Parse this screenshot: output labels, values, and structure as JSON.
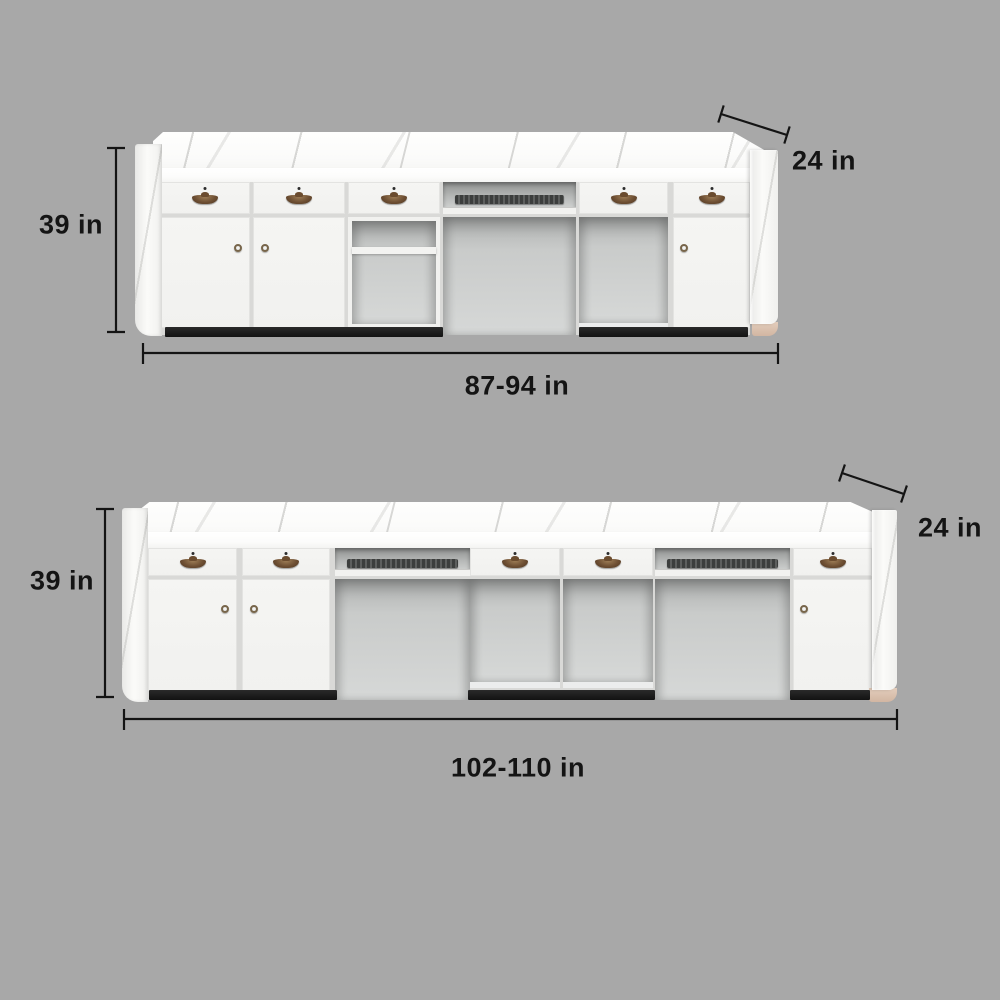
{
  "page": {
    "background_color": "#a8a8a8",
    "type": "furniture dimension diagram"
  },
  "figures": [
    {
      "name": "reception-desk-small",
      "height_label": "39 in",
      "depth_label": "24 in",
      "width_label": "87-94 in"
    },
    {
      "name": "reception-desk-large",
      "height_label": "39 in",
      "depth_label": "24 in",
      "width_label": "102-110 in"
    }
  ],
  "colors": {
    "dimension_line": "#141414",
    "label_text": "#141414",
    "desk_body": "#f3f3f1",
    "cabinet_seam": "#d9d9d7",
    "cavity_interior": "#cfd1d0",
    "toe_kick": "#1a1a1a",
    "handle_bronze": "#6e4f33",
    "foot_tan": "#d8bfac",
    "keyboard": "#4a4c4b"
  }
}
